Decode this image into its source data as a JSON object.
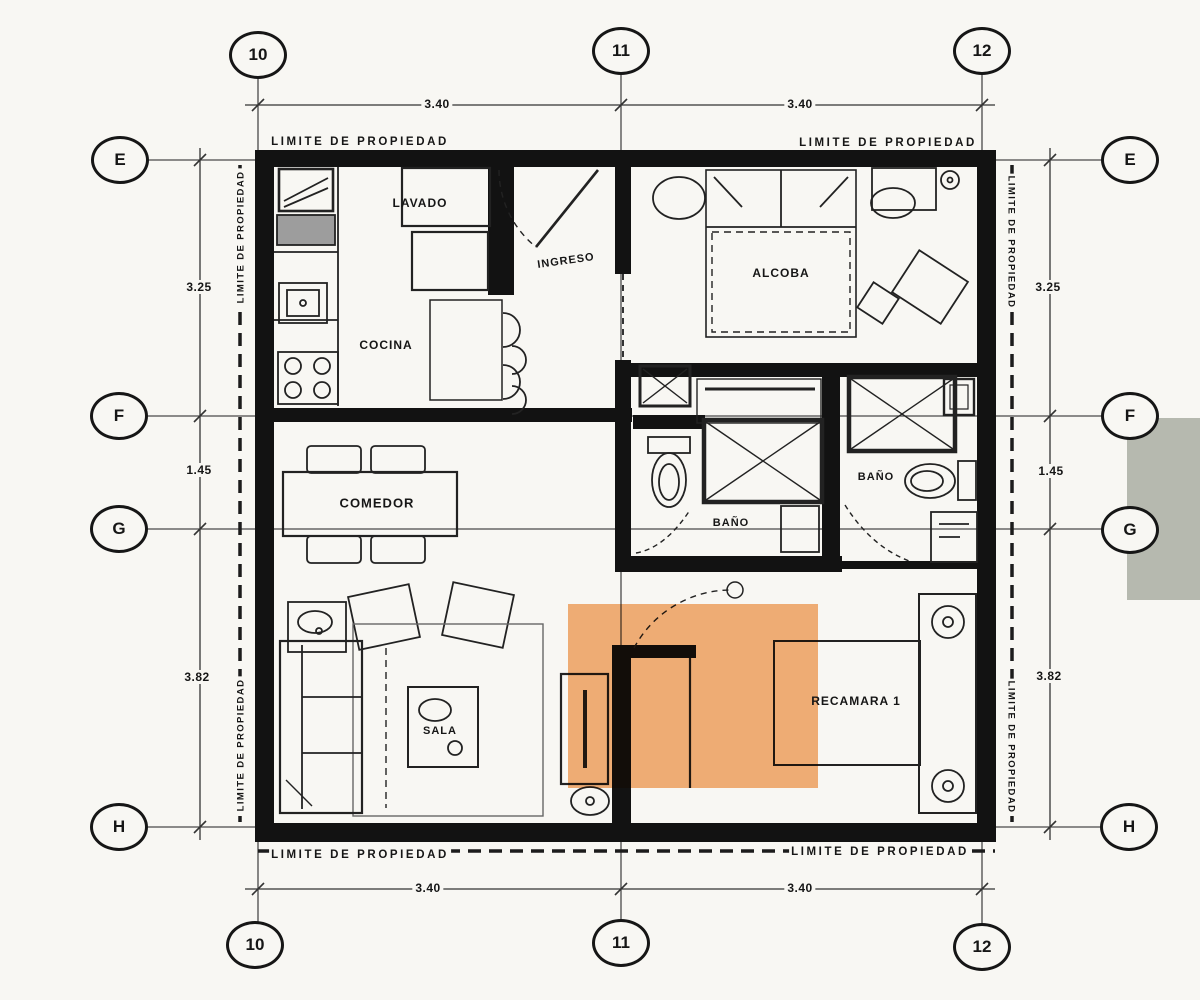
{
  "axis_markers": {
    "top": [
      "10",
      "11",
      "12"
    ],
    "bottom": [
      "10",
      "11",
      "12"
    ],
    "left": [
      "E",
      "F",
      "G",
      "H"
    ],
    "right": [
      "E",
      "F",
      "G",
      "H"
    ]
  },
  "dimensions": {
    "top": [
      "3.40",
      "3.40"
    ],
    "bottom": [
      "3.40",
      "3.40"
    ],
    "left": [
      "3.25",
      "1.45",
      "3.82"
    ],
    "right": [
      "3.25",
      "1.45",
      "3.82"
    ]
  },
  "boundary_label": "LIMITE DE PROPIEDAD",
  "rooms": {
    "lavado": "LAVADO",
    "cocina": "COCINA",
    "ingreso": "INGRESO",
    "alcoba": "ALCOBA",
    "comedor": "COMEDOR",
    "bano_1": "BAÑO",
    "bano_2": "BAÑO",
    "sala": "SALA",
    "recamara_1": "RECAMARA 1"
  },
  "colors": {
    "paper": "#f8f7f3",
    "ink": "#161616",
    "wall": "#121212",
    "highlight-orange": "#f4a463",
    "gray-block": "#b6b9af"
  }
}
